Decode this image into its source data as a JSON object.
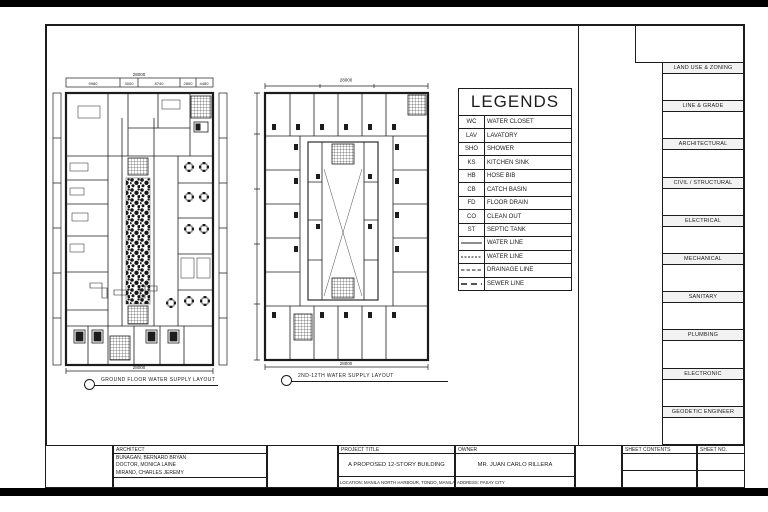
{
  "plans": {
    "plan1": {
      "caption": "GROUND FLOOR  WATER SUPPLY  LAYOUT",
      "dim_total_top": "28000",
      "dim_segments": [
        "9980",
        "3000",
        "8740",
        "2800",
        "4480"
      ],
      "dim_total_bottom": "28000"
    },
    "plan2": {
      "caption": "2ND-12TH  WATER SUPPLY  LAYOUT",
      "dim_total_top": "28000",
      "dim_total_bottom": "28000"
    }
  },
  "legends": {
    "title": "LEGENDS",
    "items": [
      {
        "abbr": "WC",
        "label": "WATER CLOSET"
      },
      {
        "abbr": "LAV",
        "label": "LAVATORY"
      },
      {
        "abbr": "SHO",
        "label": "SHOWER"
      },
      {
        "abbr": "KS",
        "label": "KITCHEN SINK"
      },
      {
        "abbr": "HB",
        "label": "HOSE BIB"
      },
      {
        "abbr": "CB",
        "label": "CATCH BASIN"
      },
      {
        "abbr": "FD",
        "label": "FLOOR DRAIN"
      },
      {
        "abbr": "CO",
        "label": "CLEAN OUT"
      },
      {
        "abbr": "ST",
        "label": "SEPTIC TANK"
      }
    ],
    "lines": [
      {
        "style": "solid",
        "label": "WATER LINE"
      },
      {
        "style": "dash-fine",
        "label": "WATER LINE"
      },
      {
        "style": "dash-med",
        "label": "DRAINAGE LINE"
      },
      {
        "style": "dash-long",
        "label": "SEWER LINE"
      }
    ]
  },
  "sidebar": {
    "sections": [
      "LAND USE & ZONING",
      "LINE & GRADE",
      "ARCHITECTURAL",
      "CIVIL / STRUCTURAL",
      "ELECTRICAL",
      "MECHANICAL",
      "SANITARY",
      "PLUMBING",
      "ELECTRONIC",
      "GEODETIC ENGINEER"
    ]
  },
  "titleblock": {
    "architect_label": "ARCHITECT",
    "architects": [
      "BUNAGAN, BERNARD BRYAN",
      "DOCTOR, MONICA LAINE",
      "MIRAND, CHARLES JEREMY"
    ],
    "project_title_label": "PROJECT TITLE",
    "project_title": "A PROPOSED 12-STORY BUILDING",
    "location": "LOCATION: MANILA NORTH HARBOUR, TONDO, MANILA",
    "owner_label": "OWNER",
    "owner": "MR. JUAN CARLO RILLERA",
    "address": "ADDRESS: PASAY CITY",
    "sheet_contents_label": "SHEET CONTENTS",
    "sheet_no_label": "SHEET NO."
  },
  "colors": {
    "ink": "#1c1c1c",
    "paper": "#ffffff"
  }
}
